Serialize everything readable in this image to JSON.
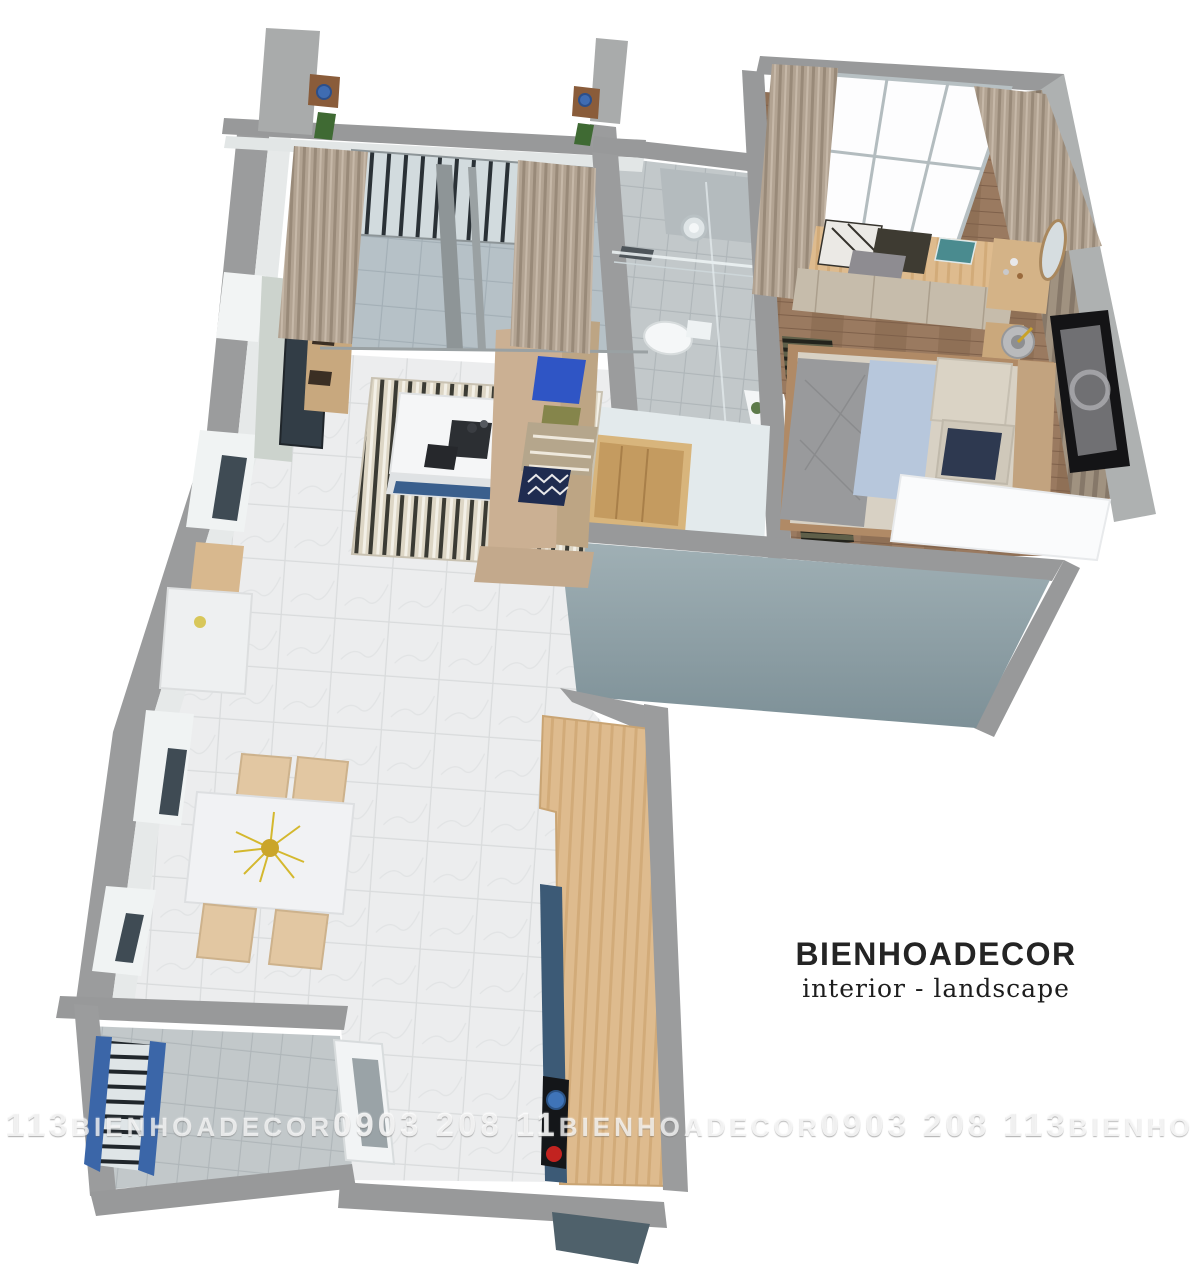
{
  "brand": {
    "logo": "BIENHOADECOR",
    "tagline": "interior - landscape"
  },
  "watermark": {
    "full_text": "113 BIENHOADECOR 0903 208 11 BIENHOADECOR 0903 208 113 BIENHOADECOR 0903 208 113 BIENHOADECOR 09",
    "phone": "0903 208 113",
    "segments": [
      "113",
      "BIENHOADECOR",
      "0903 208 11",
      "BIENHOADECOR",
      "0903 208 113",
      "BIENHOADECOR",
      "0903 208 113",
      "BIENHOADECOR",
      "09"
    ]
  },
  "scene": {
    "description": "3D cutaway floor plan render of a one-bedroom apartment viewed from above",
    "rooms": [
      "balcony",
      "living-room",
      "dining-area",
      "kitchen",
      "bathroom",
      "bedroom",
      "utility-balcony"
    ],
    "furniture": {
      "balcony": [
        "railing",
        "sliding-glass-door",
        "curtains",
        "wall-plants"
      ],
      "living_room": [
        "tv-cabinet",
        "tv",
        "wood-shelves",
        "striped-rug",
        "coffee-table",
        "sofa",
        "pillows",
        "window-nook-table",
        "nook-chair"
      ],
      "dining_area": [
        "marble-dining-table",
        "yellow-flower-centerpiece",
        "four-beige-chairs",
        "wall-windows"
      ],
      "kitchen": [
        "l-shaped-wood-counter",
        "blue-cabinets",
        "cooktop",
        "pot"
      ],
      "bathroom": [
        "glass-shower",
        "round-mirror",
        "toilet",
        "vanity",
        "plant"
      ],
      "bedroom": [
        "large-window",
        "curtains",
        "window-seat-with-pillows",
        "drawer-bench",
        "double-bed",
        "gray-blanket",
        "blue-throw",
        "dark-striped-rug",
        "bedside-table",
        "lamp",
        "vanity-desk",
        "round-mirror",
        "wall-art",
        "white-wardrobe",
        "slat-accent-wall"
      ],
      "utility_balcony": [
        "blue-railing",
        "window"
      ]
    }
  },
  "palette": {
    "background": "#ffffff",
    "wall_top": "#98999a",
    "wall_face_light": "#e6e9e9",
    "exterior_teal_wall": "#87999f",
    "marble_floor": "#ecedee",
    "wood_floor": "#9a7a60",
    "counter_wood": "#debb8e",
    "cabinet_blue": "#3c5a76",
    "sofa_beige": "#cbb093",
    "curtain_taupe": "#b2a392",
    "accent_pillow_blue": "#2f55c5",
    "railing_blue": "#3b66a8",
    "cooktop_red": "#c22320"
  }
}
